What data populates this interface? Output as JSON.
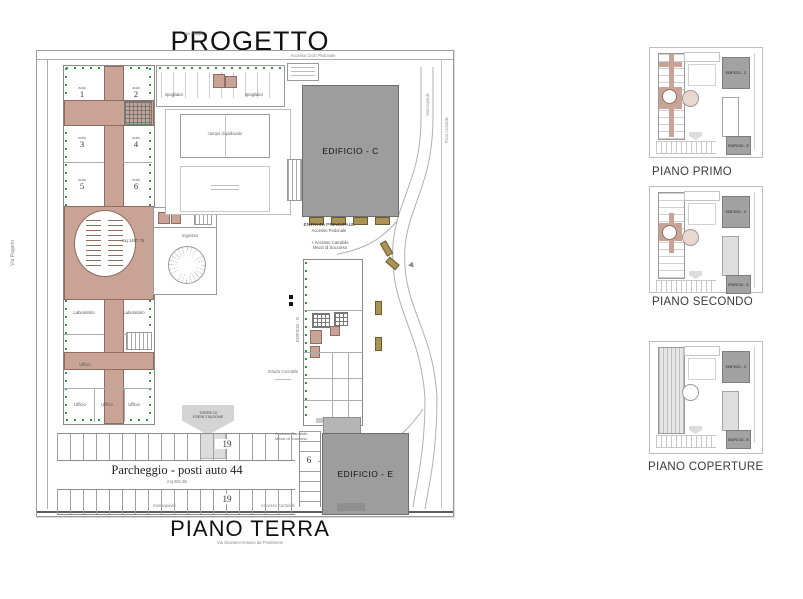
{
  "title": "PROGETTO",
  "main_plan": {
    "caption": "PIANO TERRA",
    "caption_sub": "Via Giovanni Antonio da Pordenone",
    "streets": {
      "top_left": "Via Filippo",
      "top_center": "Accesso Ciclo Pedonale",
      "left": "Via Pagano",
      "right_upper": "Marciapiede",
      "right_lower": "Pista Ciclabile",
      "bottom_left": "marciapiede",
      "bottom_right": "Accesso Carrabile"
    },
    "buildings": {
      "edificio_c": "EDIFICIO - C",
      "edificio_d": "EDIFICIO - D",
      "edificio_e": "EDIFICIO - E"
    },
    "entrance": {
      "line1": "ENTRATA PRINCIPALE",
      "line2": "Accesso Pedonale",
      "line3": "+ Accesso Carrabile",
      "line4": "Mezzi di Soccorso"
    },
    "south_access": {
      "line1": "Accesso Carrabile",
      "line2": "Mezzi di Soccorso"
    },
    "school": {
      "room_label": "aula",
      "rooms": [
        "1",
        "2",
        "3",
        "4",
        "5",
        "6"
      ],
      "lab_left": "Laboratorio",
      "lab_right": "Laboratorio",
      "office": "Ufficio",
      "offices_bottom": [
        "Ufficio",
        "Ufficio",
        "Ufficio"
      ],
      "hall_area": "mq 1487.76",
      "entrance_label": "Ingresso"
    },
    "sports": {
      "court": "campo di pallavolo",
      "locker_left": "spogliatoi",
      "locker_right": "spogliatoi"
    },
    "tower": {
      "line1": "TORRE DI",
      "line2": "ESERCITAZIONE"
    },
    "road_label": "Strada Carrabile",
    "parking": {
      "label": "Parcheggio - posti auto 44",
      "area": "mq 991.56",
      "count_top": "19",
      "count_bottom": "19",
      "count_side": "6"
    }
  },
  "side_plans": [
    {
      "label": "PIANO PRIMO",
      "c": "EDIFICIO - C",
      "e": "EDIFICIO - E"
    },
    {
      "label": "PIANO SECONDO",
      "c": "EDIFICIO - C",
      "e": "EDIFICIO - E"
    },
    {
      "label": "PIANO COPERTURE",
      "c": "EDIFICIO - C",
      "e": "EDIFICIO - E"
    }
  ],
  "colors": {
    "corridor": "#c9a496",
    "corridor_dark": "#8f6d60",
    "building_gray": "#9d9d9d",
    "roof_gray": "#dedede",
    "green": "#2f9e41",
    "khaki": "#ab9355",
    "line_gray": "#ababab"
  }
}
